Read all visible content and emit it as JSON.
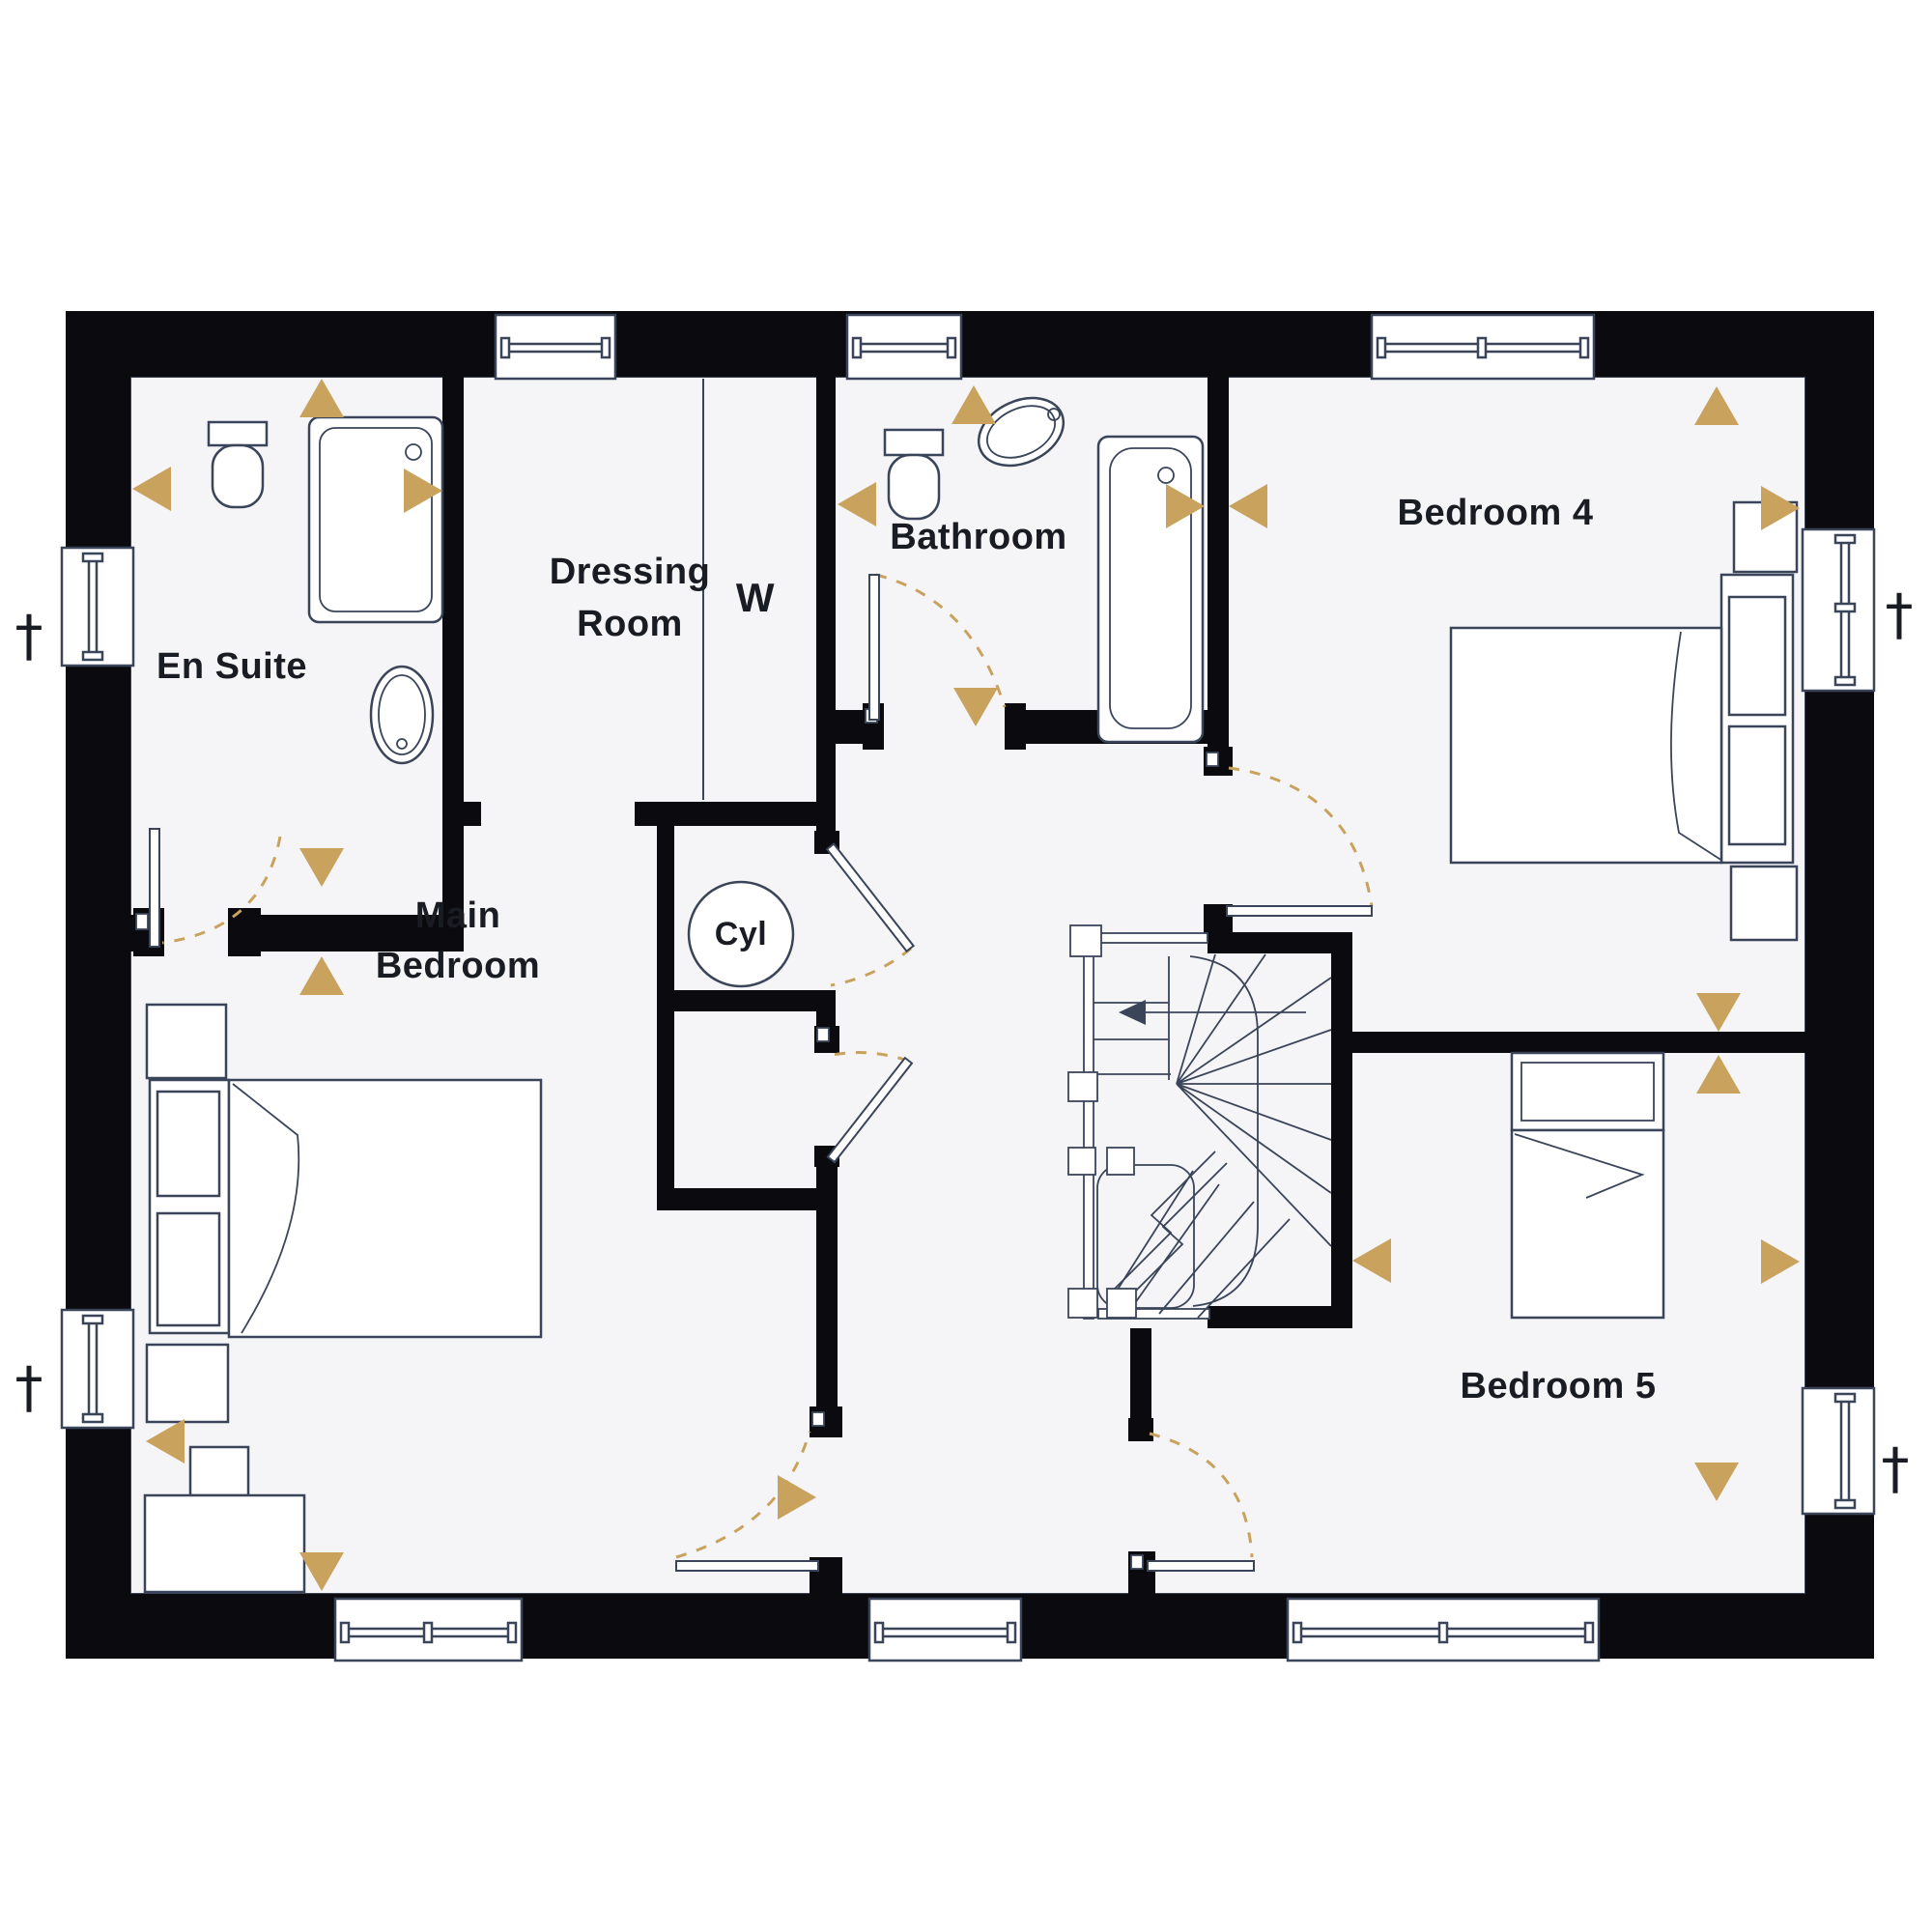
{
  "rooms": {
    "en_suite": {
      "label": "En Suite"
    },
    "dressing_room": {
      "line1": "Dressing",
      "line2": "Room"
    },
    "wardrobe": {
      "label": "W"
    },
    "bathroom": {
      "label": "Bathroom"
    },
    "bedroom_4": {
      "label": "Bedroom 4"
    },
    "main_bedroom": {
      "line1": "Main",
      "line2": "Bedroom"
    },
    "cylinder_cupboard": {
      "label": "Cyl"
    },
    "bedroom_5": {
      "label": "Bedroom 5"
    }
  },
  "markers": {
    "window_marker": "†"
  },
  "colors": {
    "wall": "#0a0a0f",
    "line": "#3a4559",
    "accent": "#c9a25e",
    "floor": "#f5f5f7",
    "text": "#191c22",
    "paper": "#ffffff"
  }
}
